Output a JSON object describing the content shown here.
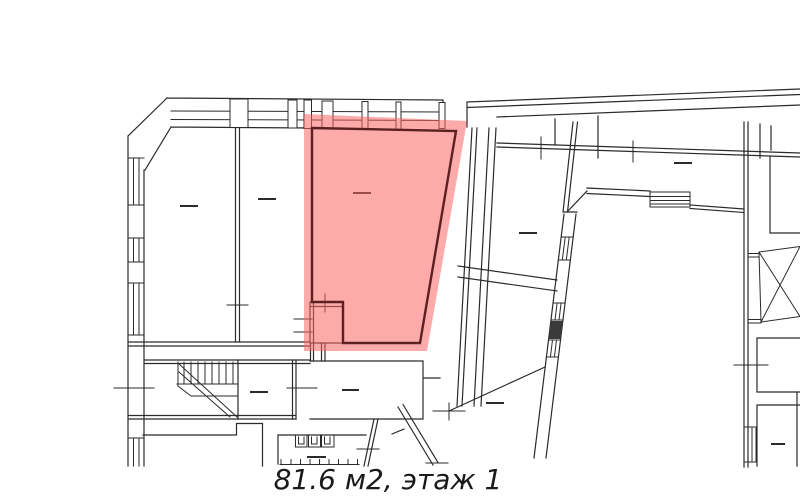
{
  "caption": {
    "text": "81.6 м2, этаж 1",
    "area": "81.6",
    "area_unit": "м2",
    "floor_word": "этаж",
    "floor_number": "1"
  },
  "highlighted_room": {
    "description": "selected-apartment-area",
    "area_label": "81.6 м2",
    "floor_label": "этаж 1"
  },
  "colors": {
    "background": "#ffffff",
    "walls": "#2b2b2b",
    "highlight_fill": "#fa6464",
    "highlight_outline": "#5d2020",
    "caption_text": "#1a1a1a"
  }
}
